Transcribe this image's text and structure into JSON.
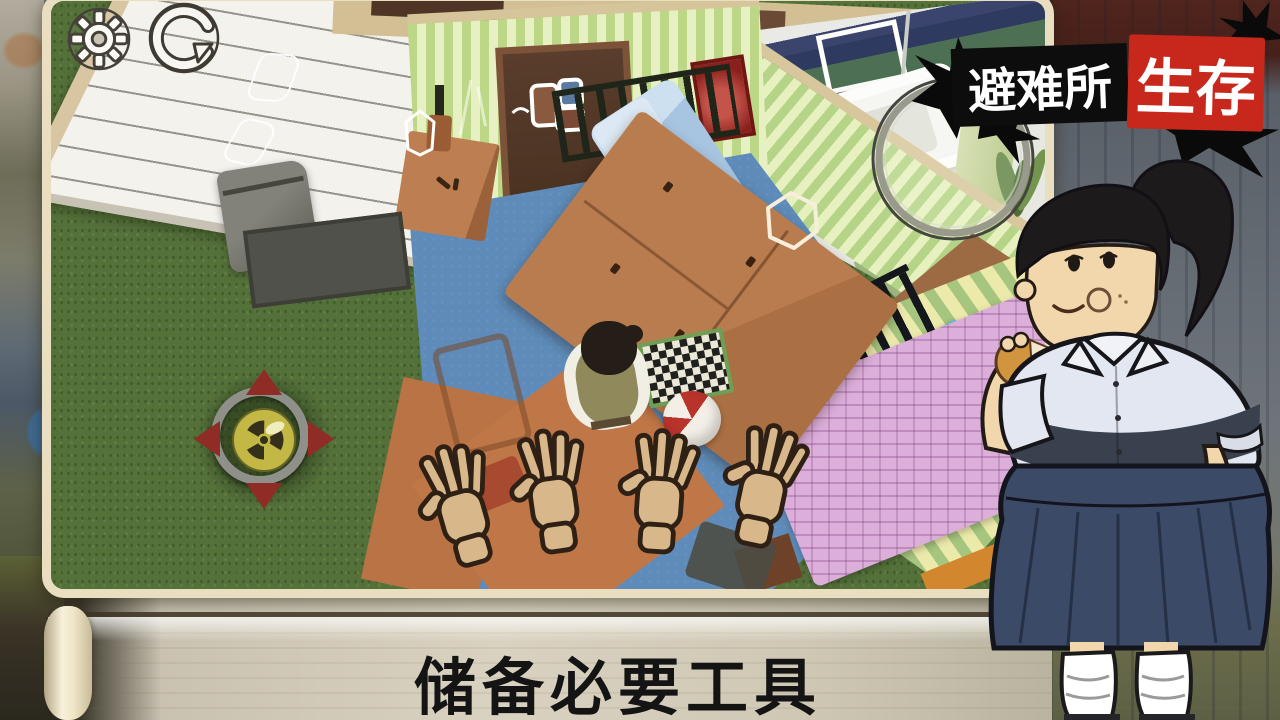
{
  "window": {
    "width": 1280,
    "height": 720,
    "type": "mobile-game-screenshot"
  },
  "title_badge": {
    "part_black": "避难所",
    "part_red": "生存",
    "colors": {
      "black_bg": "#0d0d0d",
      "red_bg": "#c8271c",
      "text": "#ffffff"
    }
  },
  "hud": {
    "settings_button": {
      "icon": "gear-icon"
    },
    "undo_button": {
      "icon": "undo-arrow-icon"
    }
  },
  "caption_banner": {
    "text": "储备必要工具",
    "style": {
      "bg": "#f4ebd0",
      "text_color": "#141414",
      "shape": "paper-scroll"
    }
  },
  "scene": {
    "view": "isometric-house-cutaway",
    "areas": [
      "grass-yard",
      "bedroom",
      "bathroom",
      "hallway"
    ],
    "hotspots": [
      {
        "name": "wardrobe-hotspot",
        "shape": "hexagon-outline"
      },
      {
        "name": "wall-hotspot",
        "shape": "rounded-outline"
      }
    ],
    "objects": [
      "white-siding",
      "navy-roof",
      "trash-bin",
      "door-mat",
      "bunker-hatch",
      "radiation-sign",
      "wardrobe",
      "desk",
      "ladder",
      "blue-bed",
      "pink-blanket-bed",
      "checkerboard",
      "beach-ball",
      "npc-top-view",
      "reaching-hands",
      "bathtub",
      "towel-rack",
      "shower",
      "green-towel",
      "pinup-poster",
      "red-painting",
      "magnifier",
      "door-sticker"
    ],
    "palette": {
      "grass": "#55713a",
      "floor_blue": "#5e8bb9",
      "wall_stripe_green": "#bcd786",
      "wall_stripe_pale": "#e7f0c2",
      "wood": "#b0744a",
      "hatch_red": "#8e2c25",
      "hatch_yellow": "#c3b845"
    }
  },
  "character": {
    "description": "girl-with-ponytail-eating-bun",
    "palette": {
      "hair": "#1d1a1c",
      "skin": "#f2d7ac",
      "shirt": "#e2e7f2",
      "shirt_shadow": "#39414f",
      "skirt": "#3b4a66",
      "socks": "#ffffff"
    }
  }
}
